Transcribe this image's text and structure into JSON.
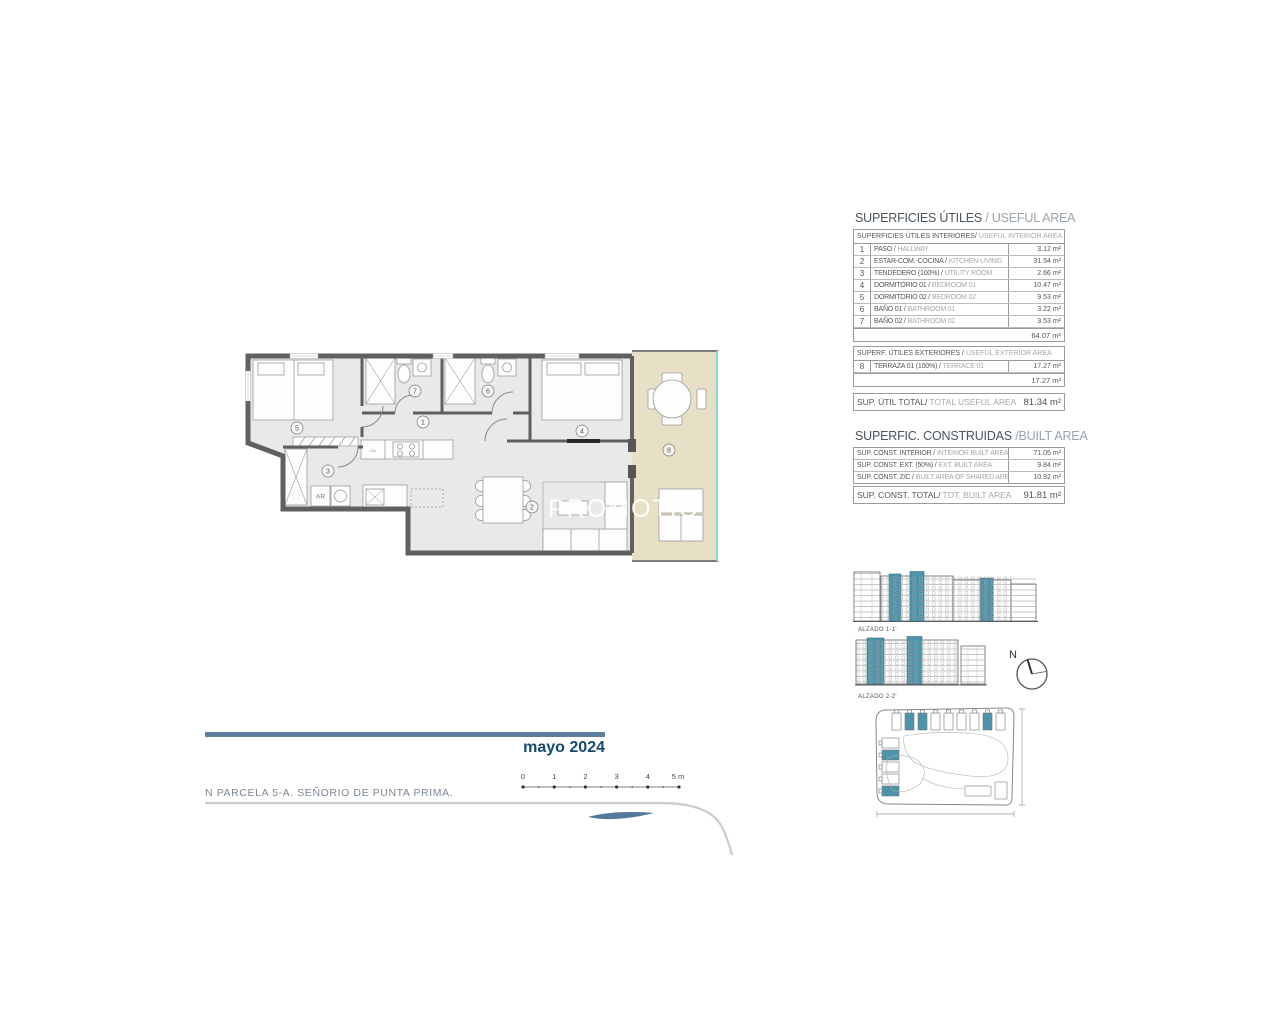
{
  "plan": {
    "watermark": "PROMOTIO",
    "rooms": [
      "1",
      "2",
      "3",
      "4",
      "5",
      "6",
      "7",
      "8"
    ],
    "ar_label": "AR",
    "cav_label": "CAV"
  },
  "useful": {
    "title_es": "SUPERFICIES ÚTILES",
    "title_en": "/ USEFUL AREA",
    "interior_header_es": "SUPERFICIES ÚTILES INTERIORES/",
    "interior_header_en": "USEFUL INTERIOR AREA",
    "rows": [
      {
        "num": "1",
        "es": "PASO /",
        "en": "HALLWAY",
        "value": "3.12 m²"
      },
      {
        "num": "2",
        "es": "ESTAR-COM.-COCINA /",
        "en": "KITCHEN-LIVING",
        "value": "31.54 m²"
      },
      {
        "num": "3",
        "es": "TENDEDERO (100%) /",
        "en": "UTILITY ROOM",
        "value": "2.66 m²"
      },
      {
        "num": "4",
        "es": "DORMITORIO 01 /",
        "en": "BEDROOM 01",
        "value": "10.47 m²"
      },
      {
        "num": "5",
        "es": "DORMITORIO 02 /",
        "en": "BEDROOM 02",
        "value": "9.53 m²"
      },
      {
        "num": "6",
        "es": "BAÑO 01 /",
        "en": "BATHROOM 01",
        "value": "3.22 m²"
      },
      {
        "num": "7",
        "es": "BAÑO 02 /",
        "en": "BATHROOM 02",
        "value": "3.53 m²"
      }
    ],
    "interior_subtotal": "64.07 m²",
    "exterior_header_es": "SUPERF. ÚTILES EXTERIORES /",
    "exterior_header_en": "USEFUL EXTERIOR AREA",
    "exterior_row": {
      "num": "8",
      "es": "TERRAZA 01 (100%) /",
      "en": "TERRACE 01",
      "value": "17.27 m²"
    },
    "exterior_subtotal": "17.27 m²",
    "total_label_es": "SUP. ÚTIL TOTAL/",
    "total_label_en": "TOTAL USEFUL AREA",
    "total_value": "81.34 m²"
  },
  "built": {
    "title_es": "SUPERFIC. CONSTRUIDAS",
    "title_en": "/BUILT AREA",
    "rows": [
      {
        "es": "SUP. CONST. INTERIOR /",
        "en": "INTERIOR BUILT AREA",
        "value": "71.05 m²"
      },
      {
        "es": "SUP. CONST. EXT. (50%) /",
        "en": "EXT. BUILT AREA",
        "value": "9.84 m²"
      },
      {
        "es": "SUP. CONST. Z/C /",
        "en": "BUILT AREA OF SHARED AREAS",
        "value": "10.92 m²"
      }
    ],
    "total_label_es": "SUP. CONST. TOTAL/",
    "total_label_en": "TOT. BUILT AREA",
    "total_value": "91.81 m²"
  },
  "elevations": {
    "alzado1": "ALZADO 1-1'",
    "alzado2": "ALZADO 2-2'"
  },
  "compass": {
    "north": "N"
  },
  "footer": {
    "date": "mayo 2024",
    "parcel": "N PARCELA 5-A. SEÑORIO DE PUNTA PRIMA.",
    "scale_ticks": [
      "0",
      "1",
      "2",
      "3",
      "4",
      "5 m"
    ]
  },
  "colors": {
    "accent_teal": "#4d93aa",
    "terrace_beige": "#e7dfc6",
    "terrace_edge_cyan": "#86d8d8",
    "bar_blue": "#5e80a0",
    "date_navy": "#17496d"
  }
}
